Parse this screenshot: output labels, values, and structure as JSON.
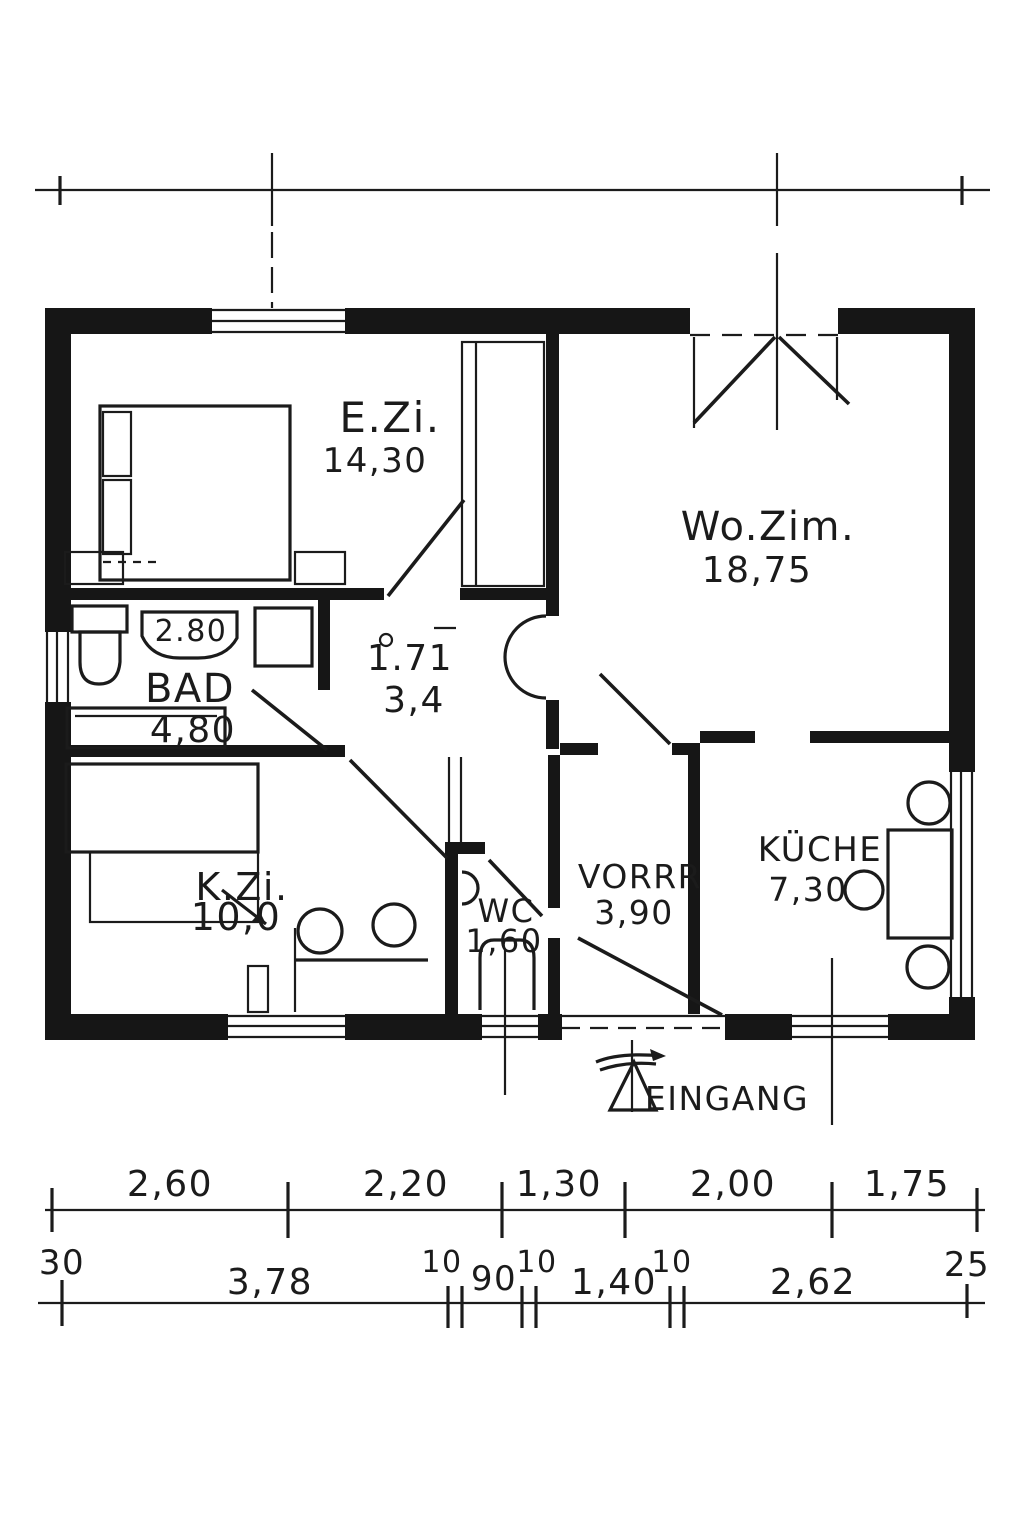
{
  "drawing": {
    "kind": "hand-drawn floor plan sketch",
    "ink_color": "#1b1b1b",
    "paper_color": "#ffffff"
  },
  "rooms": {
    "bedroom": {
      "label": "E.Zi.",
      "area": "14,30"
    },
    "living": {
      "label": "Wo.Zim.",
      "area": "18,75"
    },
    "bath": {
      "label": "BAD",
      "area": "4,80",
      "sink_label": "2.80"
    },
    "hall": {
      "label": "1.71",
      "area": "3,4"
    },
    "kids": {
      "label": "K.Zi.",
      "area": "10,0"
    },
    "wc": {
      "label": "WC",
      "area": "1,60"
    },
    "pantry": {
      "label": "VORRR",
      "area": "3,90"
    },
    "kitchen": {
      "label": "KÜCHE",
      "area": "7,30"
    }
  },
  "entrance": {
    "label": "EINGANG"
  },
  "dimensions": {
    "row1": [
      "2,60",
      "2,20",
      "1,30",
      "2,00",
      "1,75"
    ],
    "row2": [
      "30",
      "3,78",
      "10",
      "90",
      "10",
      "1,40",
      "10",
      "2,62",
      "25"
    ]
  }
}
